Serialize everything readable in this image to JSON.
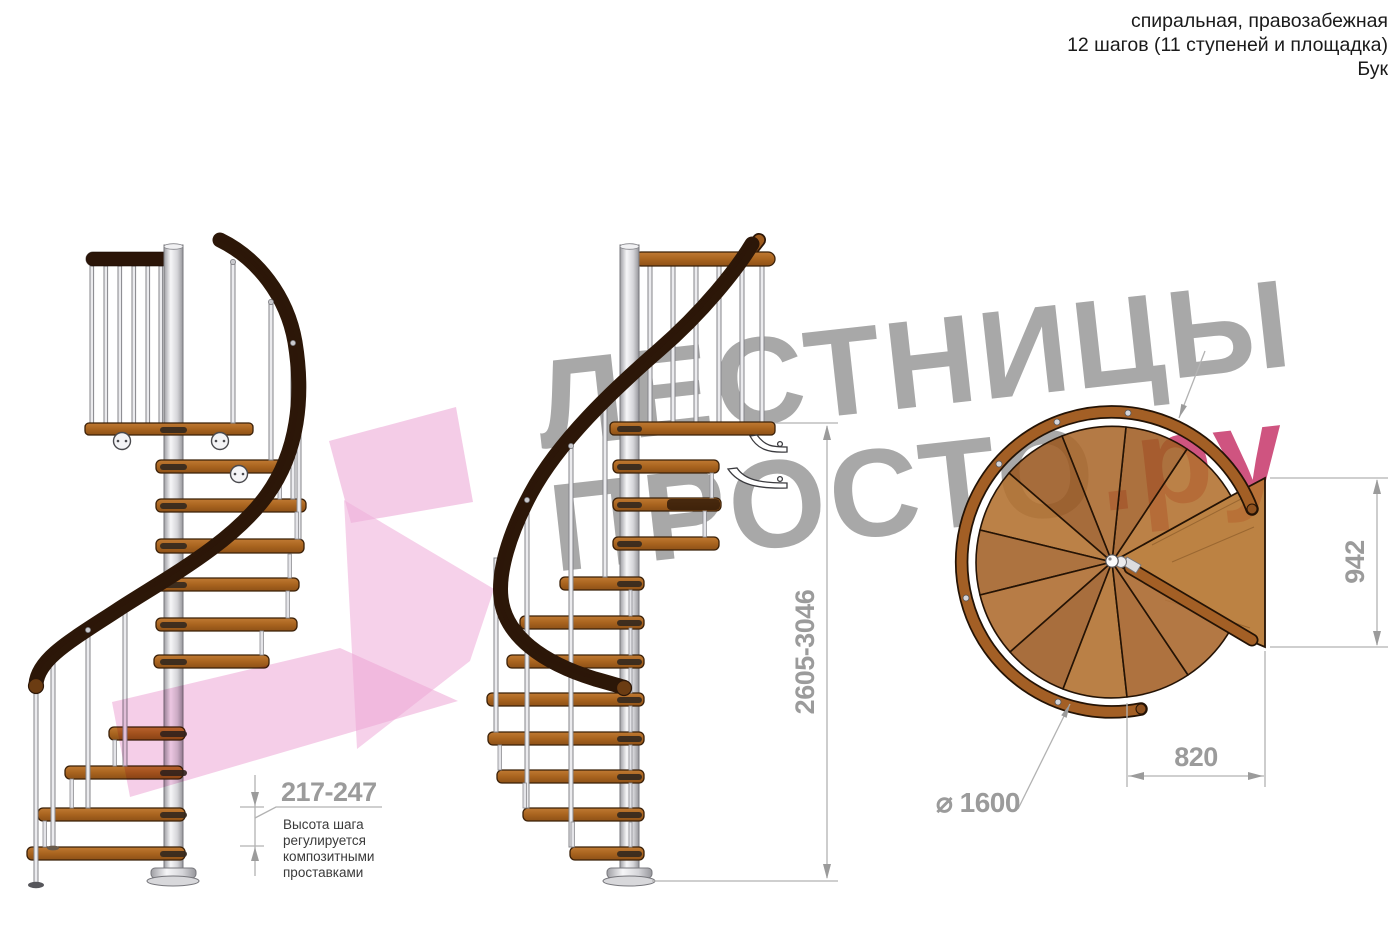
{
  "header": {
    "line1": "спиральная, правозабежная",
    "line2": "12 шагов (11 ступеней и площадка)",
    "line3": "Бук"
  },
  "watermark": {
    "word1": "ЛЕСТНИЦЫ",
    "word2": "ПРОСТО",
    "word2_suffix": ".ру",
    "text_color": "#a8a8a8",
    "accent_color": "#cf5480",
    "arrow_color": "#eda6d6"
  },
  "dimensions": {
    "total_height": "2605-3046",
    "step_height": "217-247",
    "step_height_note": [
      "Высота шага",
      "регулируется",
      "композитными",
      "проставками"
    ],
    "platform_depth": "942",
    "platform_width": "820",
    "diameter": "⌀ 1600"
  },
  "materials": {
    "wood_color": "#a9641f",
    "steel_color": "#ebebee",
    "dim_color": "#9b9b9b"
  }
}
